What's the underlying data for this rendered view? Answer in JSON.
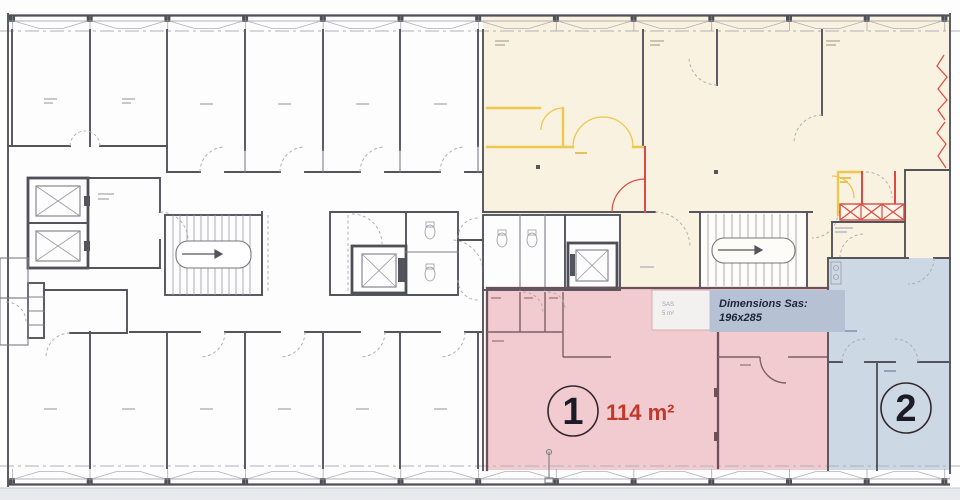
{
  "zones": {
    "unit1": {
      "number": "1",
      "area_label": "114 m²",
      "fill": "#f2cbd0",
      "wall": "#6e5158",
      "accent": "#c0392b"
    },
    "unit2": {
      "number": "2",
      "fill": "#ccd8e4"
    },
    "existing": {
      "fill": "#f9f2e0"
    }
  },
  "callout": {
    "title": "Dimensions Sas:",
    "value": "196x285",
    "bg": "#b6c2d3",
    "text_color": "#1b2737"
  },
  "sas_room": {
    "name": "SAS",
    "area": "5 m²"
  },
  "palette": {
    "wall": "#54545c",
    "wall_light": "#8f8f97",
    "door_arc": "#a9a9b1",
    "yellow": "#eec84e",
    "red": "#dd4a43",
    "page_strip": "#e9eaed"
  }
}
